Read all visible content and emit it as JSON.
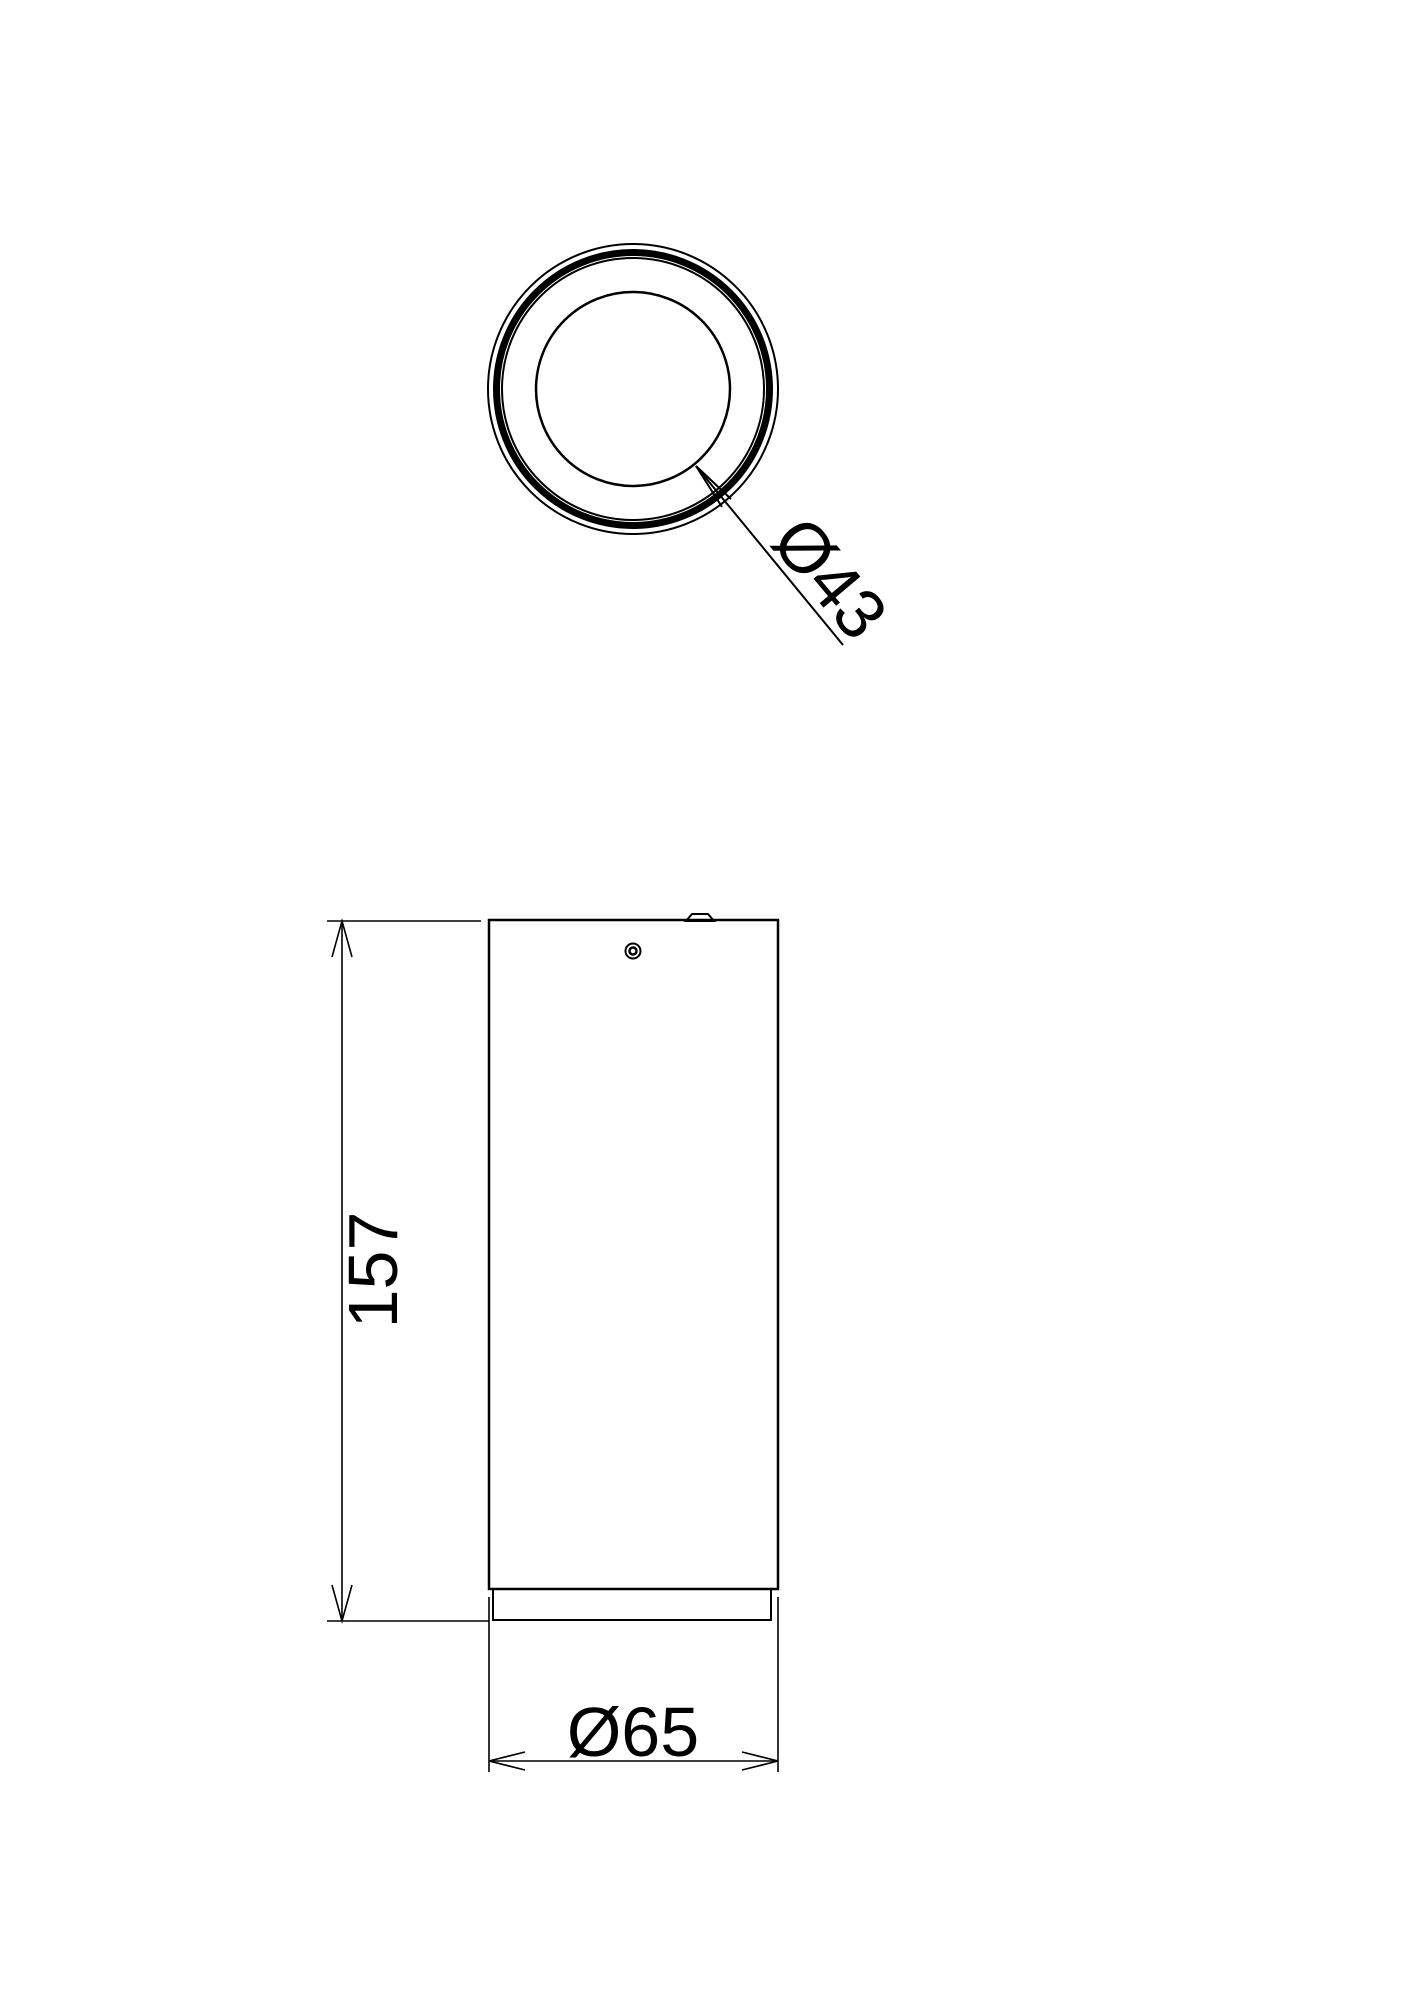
{
  "canvas": {
    "background": "#ffffff",
    "line_color": "#000000"
  },
  "top_view": {
    "lens_diameter_label": "Ø43"
  },
  "front_view": {
    "height_label": "157",
    "body_diameter_label": "Ø65"
  }
}
